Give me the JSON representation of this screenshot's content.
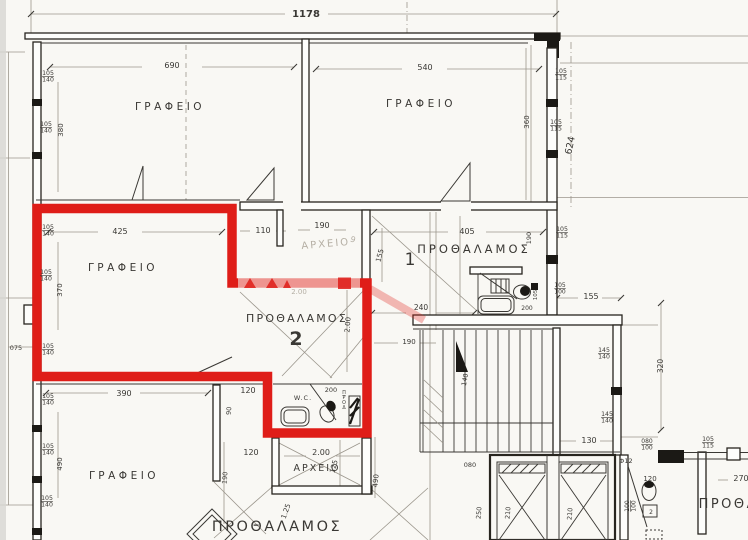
{
  "page": {
    "kind": "scanned architectural floor plan",
    "language": "Greek",
    "highlight": "red outline around unit 2"
  },
  "colors": {
    "paper": "#f9f8f4",
    "edge": "#d7d6d2",
    "ink": "#3a3834",
    "wall": "#28251f",
    "dark": "#1b1915",
    "light": "#9b968c",
    "faded": "#b5afa4",
    "red": "#df1d18",
    "pink": "rgba(223,29,24,0.30)"
  },
  "red_outline": {
    "path": "M 37 208.5 L 232 208.5 L 232 283 L 367 283 L 367 433 L 267.5 433 L 267.5 376.5 L 37 376.5 Z"
  },
  "plan": {
    "units": [
      "1",
      "2"
    ],
    "room_names": [
      "ΓΡΑΦΕΙΟ",
      "ΠΡΟΘΑΛΑΜΟΣ",
      "ΑΡΧΕΙΟ",
      "W.C."
    ],
    "labels": [
      {
        "n": "dim-total-width",
        "t": "1178",
        "x": 306,
        "y": 17,
        "s": 10,
        "b": 1
      },
      {
        "n": "dim-690",
        "t": "690",
        "x": 172,
        "y": 68,
        "s": 8
      },
      {
        "n": "dim-540",
        "t": "540",
        "x": 425,
        "y": 70,
        "s": 8
      },
      {
        "n": "room-office-top-left",
        "t": "ΓΡΑΦΕΙΟ",
        "x": 170,
        "y": 110,
        "s": 10.5,
        "ls": 3.5
      },
      {
        "n": "room-office-top-right",
        "t": "ΓΡΑΦΕΙΟ",
        "x": 421,
        "y": 107,
        "s": 10.5,
        "ls": 3.5
      },
      {
        "n": "win-105-140-a",
        "t": "105\n140",
        "x": 48,
        "y": 75,
        "s": 6.2
      },
      {
        "n": "win-105-140-b",
        "t": "105\n140",
        "x": 46,
        "y": 126,
        "s": 6.2
      },
      {
        "n": "dim-380",
        "t": "380",
        "x": 63,
        "y": 130,
        "s": 7,
        "r": -90
      },
      {
        "n": "win-105-115-a",
        "t": "105\n115",
        "x": 561,
        "y": 73,
        "s": 6.2
      },
      {
        "n": "win-105-115-b",
        "t": "105\n115",
        "x": 556,
        "y": 124,
        "s": 6.2
      },
      {
        "n": "dim-360",
        "t": "360",
        "x": 529,
        "y": 122,
        "s": 7,
        "r": -90
      },
      {
        "n": "dim-624",
        "t": "624",
        "x": 573,
        "y": 146,
        "s": 9.5,
        "r": -78
      },
      {
        "n": "dim-425",
        "t": "425",
        "x": 120,
        "y": 234,
        "s": 8
      },
      {
        "n": "dim-110",
        "t": "110",
        "x": 263,
        "y": 233,
        "s": 8
      },
      {
        "n": "dim-190-archive",
        "t": "190",
        "x": 322,
        "y": 228,
        "s": 8
      },
      {
        "n": "dim-405",
        "t": "405",
        "x": 467,
        "y": 234,
        "s": 8
      },
      {
        "n": "room-office-unit2",
        "t": "ΓΡΑΦΕΙΟ",
        "x": 123,
        "y": 271,
        "s": 10.5,
        "ls": 3.5
      },
      {
        "n": "room-archive-faded",
        "t": "ΑΡΧΕΙΟ",
        "x": 326,
        "y": 247,
        "s": 10,
        "ls": 2,
        "c": "faded",
        "r": -5
      },
      {
        "n": "scribble-9",
        "t": "9",
        "x": 352,
        "y": 242,
        "s": 8,
        "c": "faded",
        "r": 20
      },
      {
        "n": "win-105-140-c",
        "t": "105\n140",
        "x": 48,
        "y": 229,
        "s": 6.2
      },
      {
        "n": "win-105-140-d",
        "t": "105\n140",
        "x": 46,
        "y": 274,
        "s": 6.2
      },
      {
        "n": "win-105-140-e",
        "t": "105\n140",
        "x": 48,
        "y": 348,
        "s": 6.2
      },
      {
        "n": "dim-370",
        "t": "370",
        "x": 62,
        "y": 290,
        "s": 7,
        "r": -90
      },
      {
        "n": "dim-075",
        "t": "075",
        "x": 16,
        "y": 350,
        "s": 6.5
      },
      {
        "n": "dim-155-rot",
        "t": "155",
        "x": 382,
        "y": 256,
        "s": 7,
        "r": -75
      },
      {
        "n": "unit-1-number",
        "t": "1",
        "x": 410,
        "y": 265,
        "s": 17
      },
      {
        "n": "room-prothalamos-1",
        "t": "ΠΡΟΘΑΛΑΜΟΣ",
        "x": 474,
        "y": 253,
        "s": 11.5,
        "ls": 3
      },
      {
        "n": "dim-190-bath",
        "t": "190",
        "x": 531,
        "y": 238,
        "s": 6.5,
        "r": -90
      },
      {
        "n": "win-105-115-c",
        "t": "105\n115",
        "x": 562,
        "y": 231,
        "s": 6.2
      },
      {
        "n": "dim-200-faded",
        "t": "2.00",
        "x": 299,
        "y": 294,
        "s": 7,
        "c": "faded"
      },
      {
        "n": "room-prothalamos-2",
        "t": "ΠΡΟΘΑΛΑΜΟΣ",
        "x": 297,
        "y": 322,
        "s": 11,
        "ls": 2.2
      },
      {
        "n": "unit-2-number",
        "t": "2",
        "x": 296,
        "y": 345,
        "s": 19,
        "b": 1
      },
      {
        "n": "dim-200-rot",
        "t": "2.00",
        "x": 350,
        "y": 325,
        "s": 7,
        "r": -85
      },
      {
        "n": "dim-240",
        "t": "240",
        "x": 421,
        "y": 310,
        "s": 7.5
      },
      {
        "n": "win-105-100",
        "t": "105\n100",
        "x": 560,
        "y": 287,
        "s": 6
      },
      {
        "n": "dim-200-bath1",
        "t": "200",
        "x": 527,
        "y": 310,
        "s": 6
      },
      {
        "n": "dim-105-bath1",
        "t": "105",
        "x": 537,
        "y": 295,
        "s": 5.5,
        "r": -90
      },
      {
        "n": "dim-155",
        "t": "155",
        "x": 591,
        "y": 299,
        "s": 8
      },
      {
        "n": "dim-190-ledge",
        "t": "190",
        "x": 409,
        "y": 344,
        "s": 7
      },
      {
        "n": "win-145-140-a",
        "t": "145\n140",
        "x": 604,
        "y": 352,
        "s": 6.2
      },
      {
        "n": "dim-320",
        "t": "320",
        "x": 663,
        "y": 366,
        "s": 7.5,
        "r": -90
      },
      {
        "n": "dim-140-stairs",
        "t": "140",
        "x": 467,
        "y": 380,
        "s": 6.5,
        "r": -80
      },
      {
        "n": "room-wc-unit2",
        "t": "W.C.",
        "x": 303,
        "y": 400,
        "s": 6.5,
        "ls": 1
      },
      {
        "n": "dim-200-wc",
        "t": "200",
        "x": 331,
        "y": 392,
        "s": 6.5
      },
      {
        "n": "duct-text",
        "t": "Π\nΡ\nΟ\nΔ",
        "x": 344,
        "y": 394,
        "s": 4.8
      },
      {
        "n": "dim-390",
        "t": "390",
        "x": 124,
        "y": 396,
        "s": 8
      },
      {
        "n": "dim-120-a",
        "t": "120",
        "x": 248,
        "y": 393,
        "s": 8
      },
      {
        "n": "dim-90",
        "t": "90",
        "x": 231,
        "y": 411,
        "s": 6.5,
        "r": -85
      },
      {
        "n": "win-105-140-f",
        "t": "105\n140",
        "x": 48,
        "y": 398,
        "s": 6.2
      },
      {
        "n": "win-105-140-g",
        "t": "105\n140",
        "x": 48,
        "y": 448,
        "s": 6.2
      },
      {
        "n": "win-105-140-h",
        "t": "105\n140",
        "x": 47,
        "y": 500,
        "s": 6.2
      },
      {
        "n": "dim-490",
        "t": "490",
        "x": 62,
        "y": 464,
        "s": 7,
        "r": -90
      },
      {
        "n": "room-office-bottom",
        "t": "ΓΡΑΦΕΙΟ",
        "x": 124,
        "y": 479,
        "s": 10.5,
        "ls": 3.5
      },
      {
        "n": "dim-120-b",
        "t": "120",
        "x": 251,
        "y": 455,
        "s": 8
      },
      {
        "n": "dim-190-rot-b",
        "t": "190",
        "x": 227,
        "y": 478,
        "s": 6.5,
        "r": -85
      },
      {
        "n": "dim-200-archive",
        "t": "2.00",
        "x": 321,
        "y": 455,
        "s": 8
      },
      {
        "n": "dim-125",
        "t": "125",
        "x": 336,
        "y": 467,
        "s": 7,
        "r": -75
      },
      {
        "n": "room-archive-bottom",
        "t": "ΑΡΧΕΙΟ",
        "x": 317,
        "y": 471,
        "s": 9.5,
        "ls": 2
      },
      {
        "n": "dim-490-b",
        "t": "490",
        "x": 378,
        "y": 481,
        "s": 7,
        "r": -85
      },
      {
        "n": "dim-125-b",
        "t": "1.25",
        "x": 288,
        "y": 512,
        "s": 7,
        "r": -70
      },
      {
        "n": "room-prothalamos-bottom",
        "t": "ΠΡΟΘΑΛΑΜΟΣ",
        "x": 277,
        "y": 531,
        "s": 14.5,
        "ls": 2.5
      },
      {
        "n": "dim-130",
        "t": "130",
        "x": 589,
        "y": 443,
        "s": 8
      },
      {
        "n": "win-145-140-b",
        "t": "145\n140",
        "x": 607,
        "y": 416,
        "s": 6.2
      },
      {
        "n": "dim-080",
        "t": "080",
        "x": 470,
        "y": 467,
        "s": 6.5
      },
      {
        "n": "dim-250",
        "t": "250",
        "x": 481,
        "y": 513,
        "s": 6.5,
        "r": -85
      },
      {
        "n": "dim-210-lift1",
        "t": "210",
        "x": 510,
        "y": 513,
        "s": 6.5,
        "r": -85
      },
      {
        "n": "dim-210-lift2",
        "t": "210",
        "x": 572,
        "y": 514,
        "s": 6.5,
        "r": -85
      },
      {
        "n": "dim-phi12",
        "t": "Φ12",
        "x": 626,
        "y": 463,
        "s": 6.5
      },
      {
        "n": "win-080-100",
        "t": "080\n100",
        "x": 647,
        "y": 443,
        "s": 6
      },
      {
        "n": "dim-120-wc3",
        "t": "120",
        "x": 650,
        "y": 481,
        "s": 7
      },
      {
        "n": "dim-100-100",
        "t": "100\n100",
        "x": 629,
        "y": 506,
        "s": 6,
        "r": -90
      },
      {
        "n": "fixture-2",
        "t": "2",
        "x": 651,
        "y": 514,
        "s": 6
      },
      {
        "n": "win-105-115-d",
        "t": "105\n115",
        "x": 708,
        "y": 441,
        "s": 6.2
      },
      {
        "n": "dim-270",
        "t": "270",
        "x": 741,
        "y": 481,
        "s": 8
      },
      {
        "n": "room-prothalamos-right",
        "t": "ΠΡΟΘΑΛ",
        "x": 734,
        "y": 508,
        "s": 13,
        "ls": 2.5
      }
    ]
  }
}
